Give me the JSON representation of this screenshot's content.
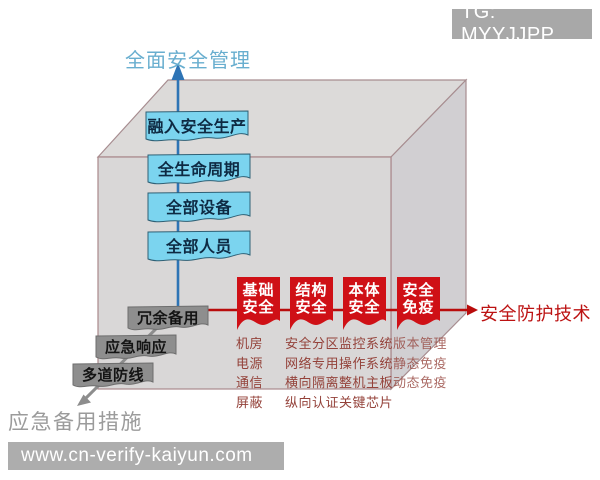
{
  "badges": {
    "tg": "TG: MYYJJPP",
    "site": "www.cn-verify-kaiyun.com"
  },
  "axes": {
    "vertical_label": "全面安全管理",
    "horizontal_label": "安全防护技术",
    "diagonal_label": "应急备用措施"
  },
  "vertical_items": [
    "融入安全生产",
    "全生命周期",
    "全部设备",
    "全部人员"
  ],
  "diagonal_items": [
    "冗余备用",
    "应急响应",
    "多道防线"
  ],
  "protection_columns": [
    {
      "title_line1": "基础",
      "title_line2": "安全",
      "items": [
        "机房",
        "电源",
        "通信",
        "屏蔽"
      ]
    },
    {
      "title_line1": "结构",
      "title_line2": "安全",
      "items": [
        "安全分区",
        "网络专用",
        "横向隔离",
        "纵向认证"
      ]
    },
    {
      "title_line1": "本体",
      "title_line2": "安全",
      "items": [
        "监控系统",
        "操作系统",
        "整机主板",
        "关键芯片"
      ]
    },
    {
      "title_line1": "安全",
      "title_line2": "免疫",
      "items": [
        "版本管理",
        "静态免疫",
        "动态免疫"
      ]
    }
  ],
  "colors": {
    "axis_blue": "#2e74b5",
    "axis_red": "#b90c0c",
    "ribbon_red": "#cf1016",
    "cyan_box_fill": "#7bd4ef",
    "gray_box_fill": "#8e8e8e",
    "cube_face_front": "#d9d7d7",
    "cube_face_top": "#dcdad9",
    "cube_face_right": "#d1cfd2",
    "cube_edge": "#a78d90",
    "label_blue": "#68aecf",
    "label_red": "#bc1212",
    "label_gray": "#9b9b9b"
  }
}
